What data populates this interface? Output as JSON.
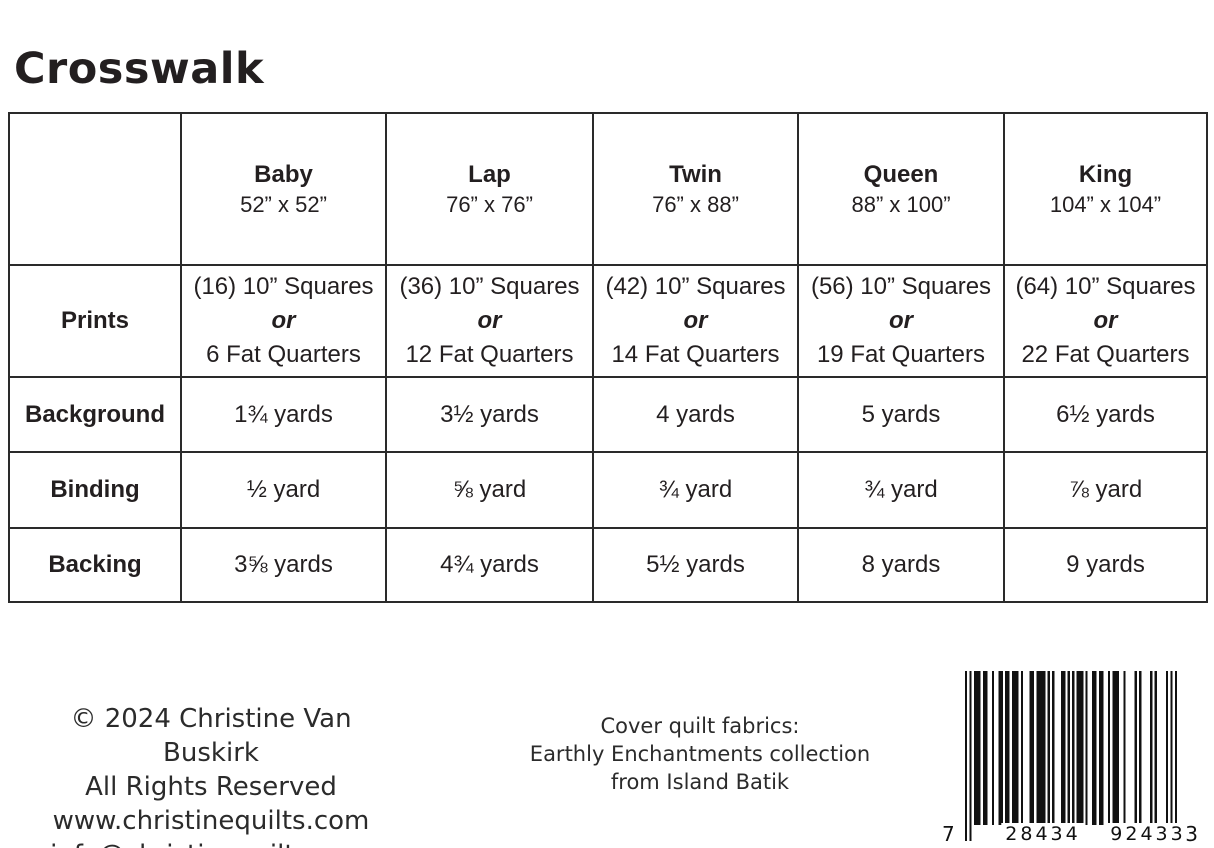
{
  "page": {
    "title": "Crosswalk"
  },
  "colors": {
    "ink": "#231f20",
    "border": "#2a2a2a",
    "background": "#ffffff"
  },
  "table": {
    "columns": [
      {
        "name": "Baby",
        "size": "52” x 52”"
      },
      {
        "name": "Lap",
        "size": "76” x 76”"
      },
      {
        "name": "Twin",
        "size": "76” x 88”"
      },
      {
        "name": "Queen",
        "size": "88” x 100”"
      },
      {
        "name": "King",
        "size": "104” x 104”"
      }
    ],
    "rows": [
      {
        "label": "Prints",
        "cells": [
          {
            "squares": "(16) 10” Squares",
            "or": "or",
            "fat_quarters": "6 Fat Quarters"
          },
          {
            "squares": "(36) 10” Squares",
            "or": "or",
            "fat_quarters": "12 Fat Quarters"
          },
          {
            "squares": "(42) 10” Squares",
            "or": "or",
            "fat_quarters": "14 Fat Quarters"
          },
          {
            "squares": "(56) 10” Squares",
            "or": "or",
            "fat_quarters": "19 Fat Quarters"
          },
          {
            "squares": "(64) 10” Squares",
            "or": "or",
            "fat_quarters": "22 Fat Quarters"
          }
        ]
      },
      {
        "label": "Background",
        "cells": [
          "1¾ yards",
          "3½  yards",
          "4 yards",
          "5 yards",
          "6½ yards"
        ]
      },
      {
        "label": "Binding",
        "cells": [
          "½ yard",
          "⅝ yard",
          "¾ yard",
          "¾ yard",
          "⅞ yard"
        ]
      },
      {
        "label": "Backing",
        "cells": [
          "3⅝ yards",
          "4¾ yards",
          "5½ yards",
          "8 yards",
          "9 yards"
        ]
      }
    ]
  },
  "footer": {
    "copyright_lines": [
      "© 2024 Christine Van Buskirk",
      "All Rights Reserved",
      "www.christinequilts.com",
      "info@christinequilts.com"
    ],
    "cover_lines": [
      "Cover quilt fabrics:",
      "Earthly Enchantments collection",
      "from Island Batik"
    ],
    "barcode": {
      "digits": "728434924333",
      "display": {
        "first": "7",
        "left": "28434",
        "right": "92433",
        "last": "3"
      }
    }
  }
}
